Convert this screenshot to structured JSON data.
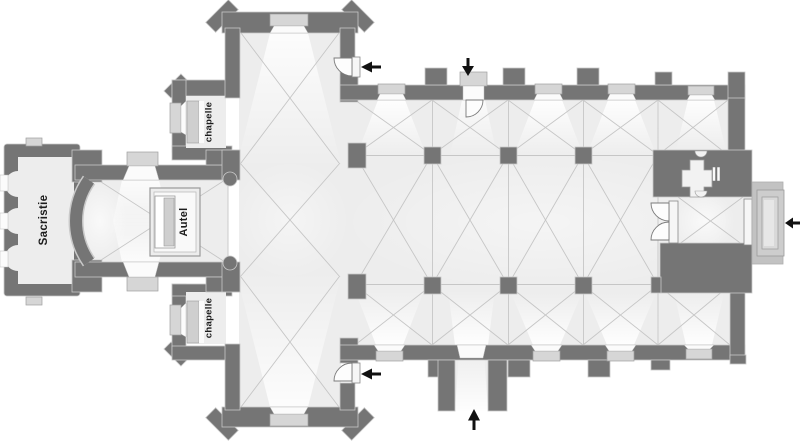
{
  "plan": {
    "type": "church-floor-plan",
    "labels": {
      "sacristy": "Sacristie",
      "altar": "Autel",
      "north_chapel": "chapelle",
      "south_chapel": "chapelle"
    },
    "entrances": [
      {
        "id": "north-transept-door",
        "arrow_direction": "left"
      },
      {
        "id": "north-nave-door",
        "arrow_direction": "down"
      },
      {
        "id": "east-portal",
        "arrow_direction": "left"
      },
      {
        "id": "south-transept-door",
        "arrow_direction": "left"
      },
      {
        "id": "south-porch",
        "arrow_direction": "up"
      }
    ],
    "colors": {
      "wall": "#757575",
      "floor": "#ededed",
      "outline": "#c9c9c9",
      "rib": "#c6c6c6",
      "window_frame": "#d6d6d6",
      "window_glass": "#fbfbfb",
      "retable": "#cfcfcf",
      "arrow": "#111111",
      "label": "#1d1d1d",
      "portal_steps": [
        "#c2c2c2",
        "#cdcdcd",
        "#d9d9d9"
      ]
    }
  }
}
